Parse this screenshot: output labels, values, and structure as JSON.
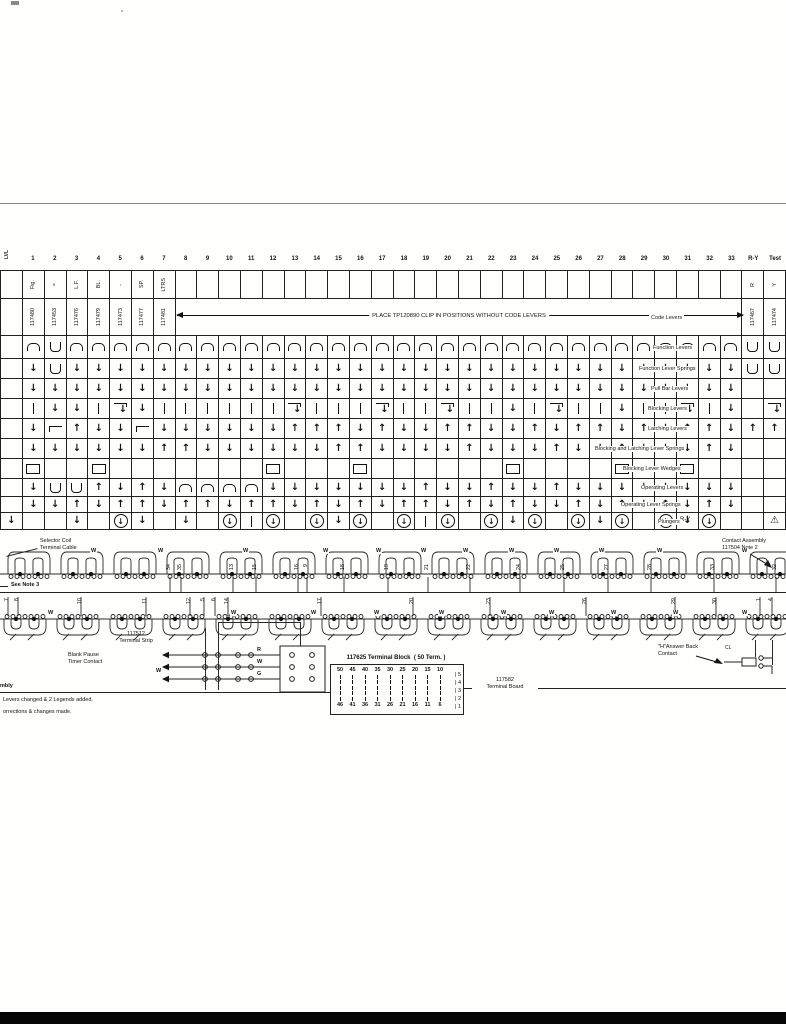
{
  "accent_colors": {
    "ink": "#141414",
    "paper": "#fefefd"
  },
  "grid": {
    "corner_label": "LVL",
    "columns": [
      "1",
      "2",
      "3",
      "4",
      "5",
      "6",
      "7",
      "8",
      "9",
      "10",
      "11",
      "12",
      "13",
      "14",
      "15",
      "16",
      "17",
      "18",
      "19",
      "20",
      "21",
      "22",
      "23",
      "24",
      "25",
      "26",
      "27",
      "28",
      "29",
      "30",
      "31",
      "32",
      "33",
      "R-Y",
      "Test"
    ],
    "clip_note": "PLACE TP120890 CLIP IN POSITIONS WITHOUT CODE LEVERS",
    "code_levers_label": "Code Levers",
    "rows": [
      {
        "name": "keys",
        "h": 28,
        "type": "text",
        "cells": [
          "",
          "Fig.",
          "=",
          "L.F.",
          "BL.",
          "-",
          "SP.",
          "LTRS",
          "",
          "",
          "",
          "",
          "",
          "",
          "",
          "",
          "",
          "",
          "",
          "",
          "",
          "",
          "",
          "",
          "",
          "",
          "",
          "",
          "",
          "",
          "",
          "",
          "",
          "",
          "R",
          "Y"
        ]
      },
      {
        "name": "part-numbers",
        "h": 37,
        "type": "parts",
        "label": "Code Levers",
        "label_x": 648,
        "cells": [
          "",
          "117480",
          "117453",
          "117476",
          "117479",
          "117473",
          "117477",
          "117481",
          "",
          "",
          "",
          "",
          "",
          "",
          "",
          "",
          "",
          "",
          "",
          "",
          "",
          "",
          "",
          "",
          "",
          "",
          "",
          "",
          "",
          "",
          "",
          "",
          "",
          "",
          "117467",
          "117474"
        ]
      },
      {
        "name": "function-levers",
        "h": 23,
        "label": "Function Levers",
        "label_x": 650,
        "cells": [
          "",
          "n",
          "u",
          "n",
          "n",
          "n",
          "n",
          "n",
          "n",
          "n",
          "n",
          "n",
          "n",
          "n",
          "n",
          "n",
          "n",
          "n",
          "n",
          "n",
          "n",
          "n",
          "n",
          "n",
          "n",
          "n",
          "n",
          "n",
          "n",
          "n",
          "n",
          "n",
          "n",
          "n",
          "u",
          "u"
        ]
      },
      {
        "name": "function-lever-springs",
        "h": 20,
        "label": "Function Lever Springs",
        "label_x": 636,
        "cells": [
          "",
          "d",
          "u",
          "d",
          "d",
          "d",
          "d",
          "d",
          "d",
          "d",
          "d",
          "d",
          "d",
          "d",
          "d",
          "d",
          "d",
          "d",
          "d",
          "d",
          "d",
          "d",
          "d",
          "d",
          "d",
          "d",
          "d",
          "d",
          "d",
          "d",
          "d",
          "d",
          "d",
          "d",
          "u",
          "u"
        ]
      },
      {
        "name": "pull-bar-levers",
        "h": 20,
        "label": "Pull Bar Levers",
        "label_x": 648,
        "cells": [
          "",
          "d",
          "d",
          "d",
          "d",
          "d",
          "d",
          "d",
          "d",
          "d",
          "d",
          "d",
          "d",
          "d",
          "d",
          "d",
          "d",
          "d",
          "d",
          "d",
          "d",
          "d",
          "d",
          "d",
          "d",
          "d",
          "d",
          "d",
          "d",
          "d",
          "d",
          "d",
          "d",
          "d",
          "",
          ""
        ]
      },
      {
        "name": "blocking-levers",
        "h": 20,
        "label": "Blocking Levers",
        "label_x": 645,
        "cells": [
          "",
          "I",
          "d",
          "d",
          "I",
          "hd",
          "d",
          "I",
          "I",
          "I",
          "I",
          "I",
          "I",
          "hd",
          "I",
          "I",
          "I",
          "hd",
          "I",
          "I",
          "hd",
          "I",
          "I",
          "d",
          "I",
          "hd",
          "I",
          "I",
          "d",
          "I",
          "I",
          "hd",
          "I",
          "d",
          "",
          "hd"
        ]
      },
      {
        "name": "latching-levers",
        "h": 20,
        "label": "Latching Levers",
        "label_x": 645,
        "cells": [
          "",
          "d",
          "h",
          "U",
          "d",
          "d",
          "h",
          "d",
          "d",
          "d",
          "d",
          "d",
          "d",
          "U",
          "U",
          "U",
          "d",
          "U",
          "d",
          "d",
          "U",
          "U",
          "d",
          "d",
          "U",
          "d",
          "U",
          "U",
          "d",
          "U",
          "d",
          "U",
          "U",
          "d",
          "U",
          "U"
        ]
      },
      {
        "name": "blocking-latching-springs",
        "h": 20,
        "label": "Blocking and Latching Lever Springs",
        "label_x": 592,
        "cells": [
          "",
          "d",
          "d",
          "d",
          "d",
          "d",
          "d",
          "U",
          "U",
          "d",
          "d",
          "d",
          "d",
          "d",
          "d",
          "U",
          "U",
          "d",
          "d",
          "d",
          "d",
          "U",
          "d",
          "d",
          "d",
          "U",
          "d",
          "d",
          "U",
          "d",
          "d",
          "d",
          "U",
          "d",
          "",
          ""
        ]
      },
      {
        "name": "blocking-lever-wedges",
        "h": 20,
        "label": "Blocking Lever Wedges",
        "label_x": 620,
        "cells": [
          "",
          "q",
          "",
          "",
          "q",
          "",
          "",
          "",
          "",
          "",
          "",
          "",
          "q",
          "",
          "",
          "",
          "q",
          "",
          "",
          "",
          "",
          "",
          "",
          "q",
          "",
          "",
          "",
          "",
          "q",
          "",
          "",
          "q",
          "",
          "",
          "",
          ""
        ]
      },
      {
        "name": "operating-levers",
        "h": 18,
        "label": "Operating Levers",
        "label_x": 638,
        "cells": [
          "",
          "d",
          "u",
          "u",
          "U",
          "d",
          "U",
          "d",
          "n",
          "n",
          "n",
          "n",
          "d",
          "d",
          "d",
          "d",
          "d",
          "d",
          "d",
          "U",
          "d",
          "d",
          "U",
          "d",
          "d",
          "U",
          "d",
          "d",
          "d",
          "d",
          "d",
          "d",
          "d",
          "d",
          "",
          ""
        ]
      },
      {
        "name": "operating-lever-springs",
        "h": 16,
        "label": "Operating Lever Springs",
        "label_x": 618,
        "cells": [
          "",
          "d",
          "d",
          "U",
          "d",
          "U",
          "U",
          "d",
          "U",
          "U",
          "d",
          "U",
          "U",
          "d",
          "U",
          "d",
          "U",
          "d",
          "U",
          "U",
          "d",
          "U",
          "d",
          "U",
          "d",
          "d",
          "U",
          "d",
          "U",
          "d",
          "U",
          "d",
          "U",
          "d",
          "",
          ""
        ]
      },
      {
        "name": "plungers",
        "h": 17,
        "label": "Plungers",
        "label_x": 655,
        "cells": [
          "d",
          "",
          "",
          "d",
          "",
          "cd",
          "d",
          "",
          "d",
          "",
          "cd",
          "I",
          "cd",
          "",
          "cd",
          "d",
          "cd",
          "",
          "cd",
          "I",
          "cd",
          "",
          "cd",
          "d",
          "cd",
          "",
          "cd",
          "d",
          "cd",
          "",
          "cd",
          "d",
          "cd",
          "",
          "",
          "tr"
        ]
      }
    ]
  },
  "callouts": {
    "selector_coil": "Selector Coil\nTerminal Cable",
    "see_note": "See Note 3",
    "ry_label": "R-Y",
    "contact_assembly": "Contact Assembly\n117504 Note 2",
    "answer_back": "\"H\"Answer Back\nContact",
    "cl_label": "CL",
    "terminal_strip": "117512\nTerminal Strip",
    "blank_pause": "Blank Pause\nTimer Contact",
    "strip_wire_letters": [
      "R",
      "W",
      "G"
    ],
    "terminal_board": "117582\nTerminal Board",
    "notes_fragment": "mbly",
    "note_line_1": "Levers changed & 2 Legends added.",
    "note_line_2": "orrections & changes made."
  },
  "terminal_block": {
    "title": "117625 Terminal Block  ( 50 Term. )",
    "top_numbers": [
      "50",
      "45",
      "40",
      "35",
      "30",
      "25",
      "20",
      "15",
      "10"
    ],
    "bottom_numbers": [
      "46",
      "41",
      "36",
      "31",
      "26",
      "21",
      "16",
      "11",
      "6"
    ],
    "right_numbers": [
      "5",
      "4",
      "3",
      "2",
      "1"
    ]
  },
  "wire_numbers": {
    "upper": [
      [
        "34",
        166
      ],
      [
        "35",
        177
      ],
      [
        "13",
        229
      ],
      [
        "15",
        252
      ],
      [
        "16",
        294
      ],
      [
        "9",
        303
      ],
      [
        "18",
        340
      ],
      [
        "19",
        384
      ],
      [
        "21",
        424
      ],
      [
        "22",
        466
      ],
      [
        "24",
        516
      ],
      [
        "25",
        560
      ],
      [
        "27",
        604
      ],
      [
        "28",
        647
      ],
      [
        "33",
        710
      ],
      [
        "32",
        772
      ]
    ],
    "lower": [
      [
        "7",
        4
      ],
      [
        "8",
        14
      ],
      [
        "10",
        77
      ],
      [
        "11",
        142
      ],
      [
        "12",
        186
      ],
      [
        "5",
        200
      ],
      [
        "6",
        211
      ],
      [
        "14",
        224
      ],
      [
        "17",
        317
      ],
      [
        "20",
        409
      ],
      [
        "23",
        486
      ],
      [
        "26",
        582
      ],
      [
        "29",
        671
      ],
      [
        "30",
        712
      ],
      [
        "1",
        756
      ],
      [
        "4",
        768
      ]
    ],
    "w_upper_x": [
      90,
      157,
      242,
      322,
      375,
      420,
      462,
      508,
      553,
      598,
      656,
      741
    ],
    "w_lower_x": [
      47,
      230,
      310,
      373,
      438,
      500,
      548,
      610,
      672,
      741
    ],
    "w_strip_x": 158
  }
}
